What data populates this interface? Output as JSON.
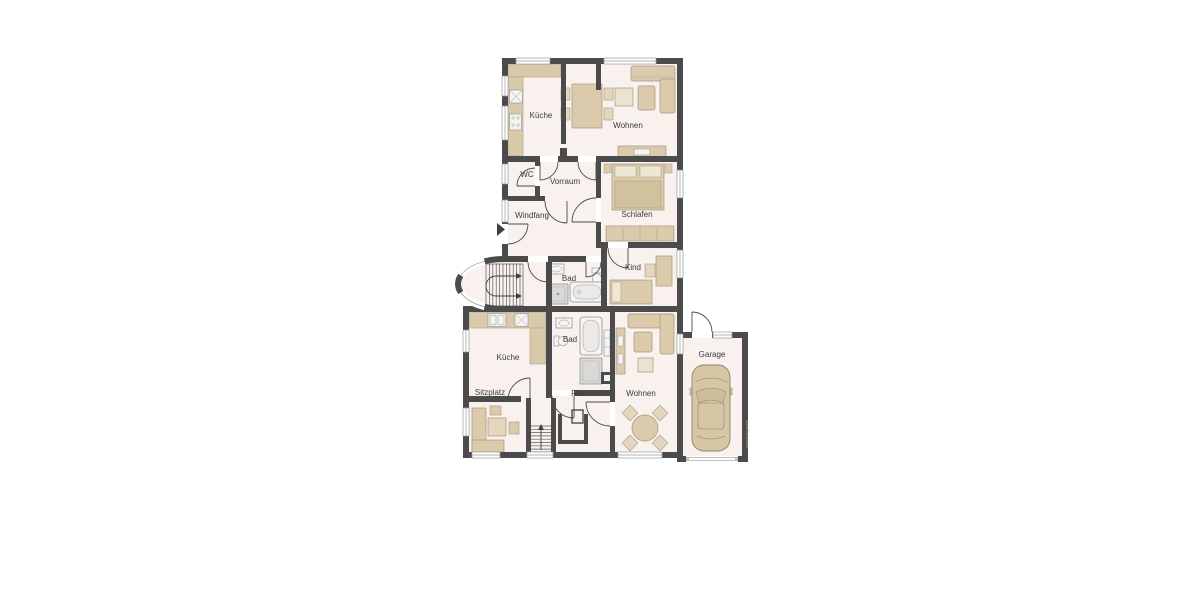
{
  "floorplan": {
    "labels": {
      "kueche_og": "Küche",
      "wohnen_og": "Wohnen",
      "wc": "WC",
      "vorraum": "Vorraum",
      "windfang": "Windfang",
      "schlafen": "Schlafen",
      "bad_og": "Bad",
      "kind": "Kind",
      "kueche_eg": "Küche",
      "bad_eg": "Bad",
      "sitzplatz": "Sitzplatz",
      "flur": "Flur",
      "wohnen_eg": "Wohnen",
      "garage": "Garage"
    },
    "watermark": "MeinGrundriss",
    "colors": {
      "background": "#ffffff",
      "wall": "#4b4b4b",
      "floor": "#f8f1ee",
      "furniture": "#dbcaac",
      "furniture_stroke": "#a6977c",
      "furniture_light": "#ece2cf",
      "fixture": "#f5f4f2",
      "fixture_stroke": "#8f8f8f",
      "window_frame": "#9a9a9a",
      "label": "#3c3c3c"
    }
  }
}
